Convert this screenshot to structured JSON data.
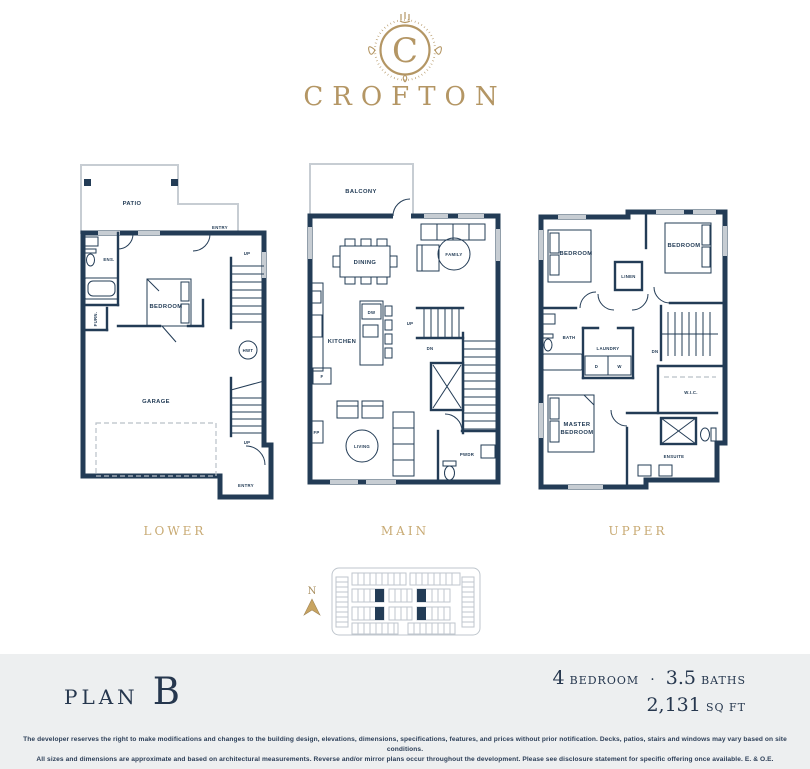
{
  "logo": {
    "monogram": "C",
    "name": "CROFTON"
  },
  "floor_labels": {
    "lower": "LOWER",
    "main": "MAIN",
    "upper": "UPPER"
  },
  "rooms": {
    "lower": {
      "patio": "PATIO",
      "entry_top": "ENTRY",
      "ens": "ENS.",
      "bedroom": "BEDROOM",
      "furn": "FURN.",
      "garage": "GARAGE",
      "hwt": "HWT",
      "up_upper": "UP",
      "up_lower": "UP",
      "entry_bottom": "ENTRY"
    },
    "main": {
      "balcony": "BALCONY",
      "dining": "DINING",
      "family": "FAMILY",
      "kitchen": "KITCHEN",
      "dw": "DW",
      "fridge": "F",
      "fp": "FP",
      "living": "LIVING",
      "up": "UP",
      "dn": "DN",
      "pwdr": "PWDR"
    },
    "upper": {
      "bedroom_left": "BEDROOM",
      "bedroom_right": "BEDROOM",
      "linen": "LINEN",
      "bath": "BATH",
      "laundry": "LAUNDRY",
      "dryer": "D",
      "washer": "W",
      "dn": "DN",
      "wic": "W.I.C.",
      "master_line1": "MASTER",
      "master_line2": "BEDROOM",
      "ensuite": "ENSUITE"
    }
  },
  "compass": {
    "north": "N"
  },
  "plan": {
    "prefix": "PLAN",
    "letter": "B"
  },
  "specs": {
    "bed_count": "4",
    "bed_label": "BEDROOM",
    "separator": "·",
    "bath_count": "3.5",
    "bath_label": "BATHS",
    "area_value": "2,131",
    "area_label": "SQ FT"
  },
  "disclaimer": {
    "line1": "The developer reserves the right to make modifications and changes to the building design, elevations, dimensions, specifications, features, and prices without prior notification. Decks, patios, stairs and windows may vary based on site conditions.",
    "line2": "All sizes and dimensions are approximate and based on architectural measurements. Reverse and/or mirror plans occur throughout the development. Please see disclosure statement for specific offering once available. E. & O.E."
  },
  "colors": {
    "navy": "#233C56",
    "gold": "#B49664",
    "gold_label": "#C8AA73",
    "band_bg": "#EDEFF0",
    "light_line": "#C7CDD3"
  }
}
